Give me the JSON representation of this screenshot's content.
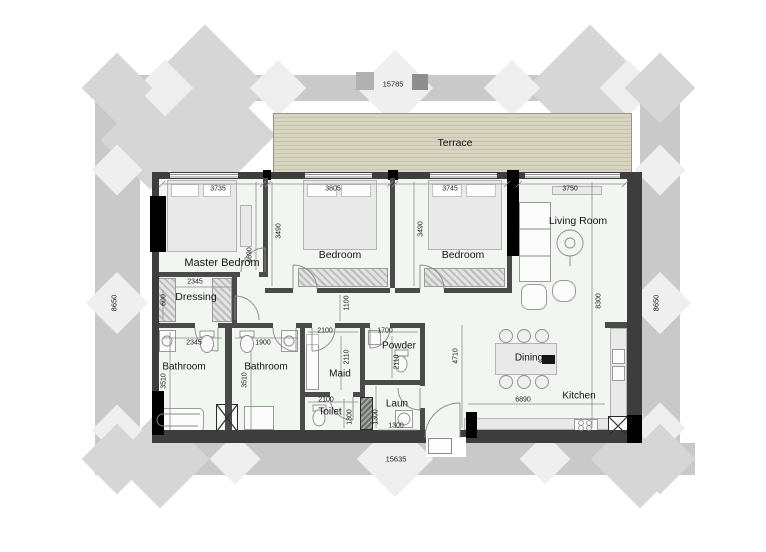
{
  "plan": {
    "overall": {
      "top": "15785",
      "bottom": "15635",
      "left": "8650",
      "right": "8650"
    },
    "rooms": {
      "terrace": {
        "label": "Terrace"
      },
      "master": {
        "label": "Master Bedrom",
        "width": "3735",
        "height": "4690"
      },
      "bedroom2": {
        "label": "Bedroom",
        "width": "3805",
        "height": "3490"
      },
      "bedroom3": {
        "label": "Bedroom",
        "width": "3745",
        "height": "3490"
      },
      "living": {
        "label": "Living Room",
        "width": "3750",
        "height": "8300"
      },
      "hallway": {
        "width": "1100"
      },
      "dressing": {
        "label": "Dressing",
        "width": "2345",
        "depth": "600"
      },
      "bathroom1": {
        "label": "Bathroom",
        "width": "2345",
        "height": "3510"
      },
      "bathroom2": {
        "label": "Bathroom",
        "width": "1900",
        "height": "3510"
      },
      "maid": {
        "label": "Maid",
        "width": "2100",
        "height": "2110"
      },
      "powder": {
        "label": "Powder",
        "width": "1700",
        "height": "2110"
      },
      "toilet": {
        "label": "Toilet",
        "width": "2100",
        "height": "1300"
      },
      "laundry": {
        "label": "Laun",
        "width": "1300",
        "height": "1300"
      },
      "dining": {
        "label": "Dining",
        "height": "4710"
      },
      "kitchen": {
        "label": "Kitchen",
        "width": "6890"
      }
    },
    "colors": {
      "wall": "#3d3d3d",
      "structural": "#000000",
      "terrace": "#d9d5c3",
      "floor": "#f2f6f1",
      "band": "#c9c9c9"
    }
  }
}
